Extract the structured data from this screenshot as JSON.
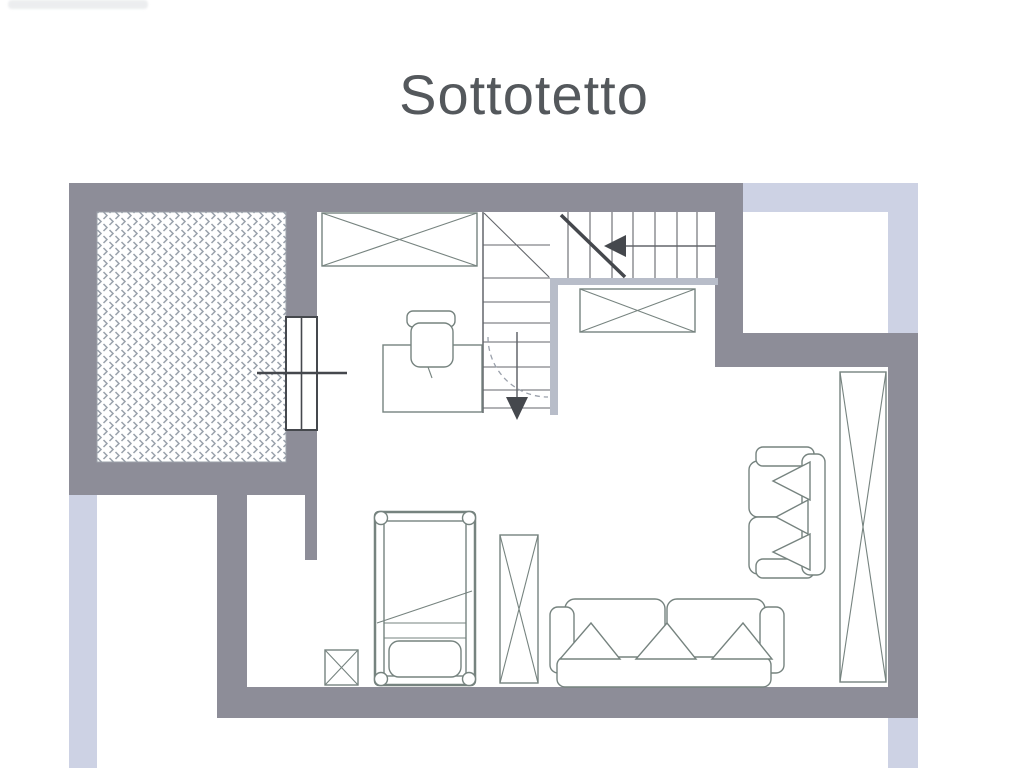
{
  "page": {
    "title": "Sottotetto"
  },
  "colors": {
    "paper": "#ffffff",
    "wall": "#8d8d98",
    "roof-edge": "#cdd2e4",
    "stair-wall": "#b8bdc9",
    "furniture-line": "#76837f",
    "stair-line": "#63666b",
    "dark-line": "#45484d",
    "hatch": "#99a1ab",
    "title-text": "#54585c"
  },
  "plan": {
    "floor_name": "Sottotetto",
    "elements": [
      {
        "name": "terrace-hatched-area"
      },
      {
        "name": "window-door-element"
      },
      {
        "name": "staircase-down"
      },
      {
        "name": "wardrobe-x-top"
      },
      {
        "name": "wardrobe-x-landing"
      },
      {
        "name": "desk"
      },
      {
        "name": "desk-chair"
      },
      {
        "name": "single-bed"
      },
      {
        "name": "nightstand"
      },
      {
        "name": "wardrobe-x-mid"
      },
      {
        "name": "wardrobe-x-right"
      },
      {
        "name": "sofa-three-seat"
      },
      {
        "name": "sofa-two-seat"
      }
    ]
  }
}
